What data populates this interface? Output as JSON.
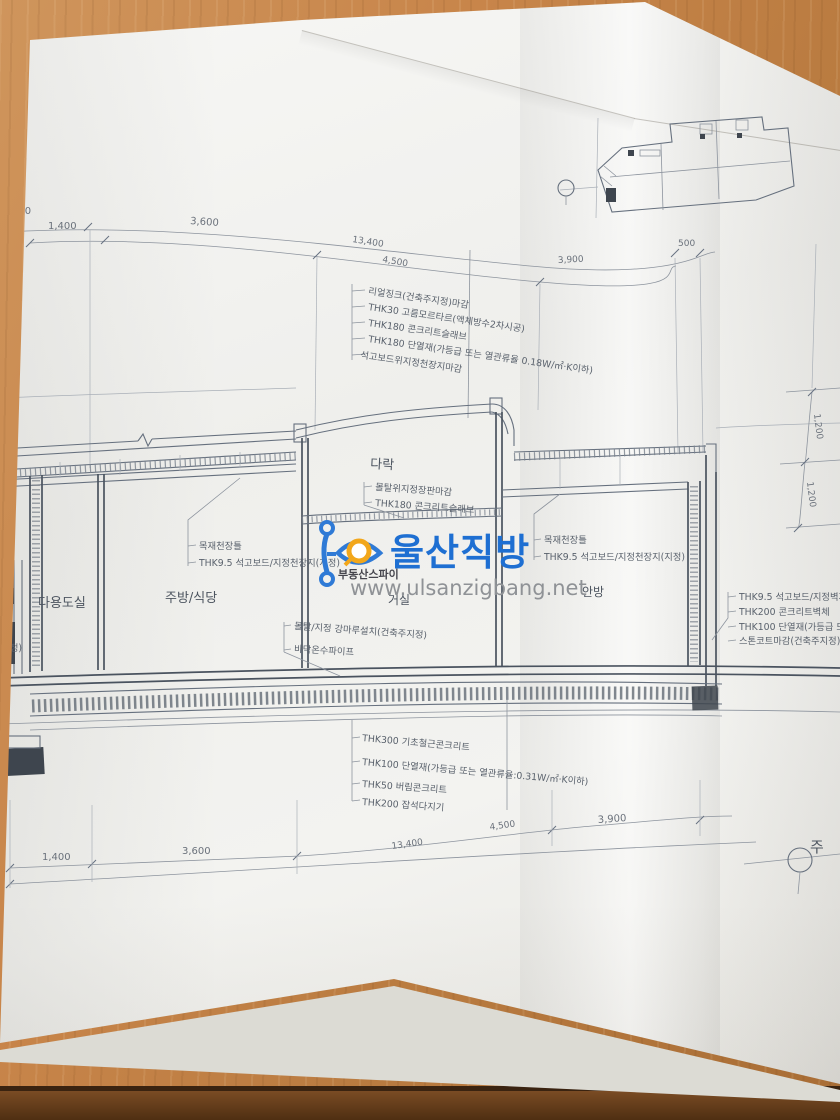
{
  "photo": {
    "description": "architectural-section-blueprint-on-wood-desk",
    "paper_color": "#f3f3f0",
    "wood_color": "#c8854a",
    "line_color": "#66707e"
  },
  "watermark": {
    "brand": "울산직방",
    "subtitle": "부동산스파이",
    "url": "www.ulsanzigbang.net",
    "brand_color": "#1e6fd2",
    "accent_color": "#f2a71b"
  },
  "drawing": {
    "rooms": {
      "utility": "다용도실",
      "kitchen": "주방/식당",
      "living": "거실",
      "master": "안방",
      "attic": "다락"
    },
    "roof_notes": [
      "리얼징크(건축주지정)마감",
      "THK30 고름모르타르(액체방수2차시공)",
      "THK180 콘크리트슬래브",
      "THK180 단열재(가등급 또는 열관류율 0.18W/㎡·K이하)",
      "석고보드위지정천장지마감"
    ],
    "attic_notes": [
      "몰탈위지정장판마감",
      "THK180 콘크리트슬래브"
    ],
    "ceiling_notes_left": [
      "목재천장틀",
      "THK9.5 석고보드/지정천장지(지정)"
    ],
    "ceiling_notes_right": [
      "목재천장틀",
      "THK9.5 석고보드/지정천장지(지정)"
    ],
    "wall_notes_right": [
      "THK9.5 석고보드/지정벽지",
      "THK200 콘크리트벽체",
      "THK100 단열재(가등급 또는",
      "스톤코트마감(건축주지정)"
    ],
    "floor_notes": [
      "몰탈/지정 강마루설치(건축주지정)",
      "바닥온수파이프"
    ],
    "foundation_notes": [
      "THK300 기초철근콘크리트",
      "THK100 단열재(가등급 또는 열관류율:0.31W/㎡·K이하)",
      "THK50 버림콘크리트",
      "THK200 잡석다지기"
    ],
    "partial_note_left": "(건축주지정)",
    "dimensions_top": [
      "500",
      "1,400",
      "3,600",
      "13,400",
      "4,500",
      "3,900",
      "500"
    ],
    "dimensions_bottom": [
      "1,400",
      "3,600",
      "13,400",
      "4,500",
      "3,900"
    ],
    "dimensions_right": [
      "1,200",
      "1,200"
    ],
    "grid_marker": "주"
  }
}
